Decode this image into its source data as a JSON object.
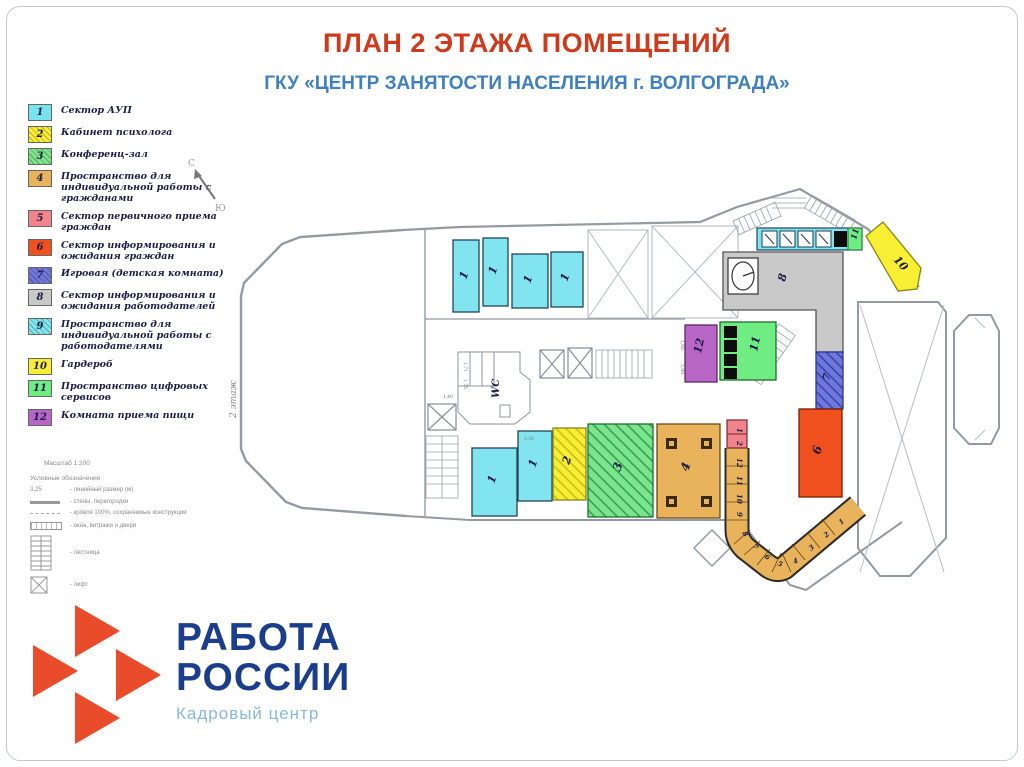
{
  "title": "ПЛАН 2 ЭТАЖА ПОМЕЩЕНИЙ",
  "subtitle": "ГКУ «ЦЕНТР ЗАНЯТОСТИ НАСЕЛЕНИЯ г. ВОЛГОГРАДА»",
  "colors": {
    "title": "#ce3a1c",
    "subtitle": "#4080c0",
    "logo_orange": "#e84c2b",
    "logo_blue": "#1b3e8c",
    "logo_lightblue": "#8ab8dc"
  },
  "legend": {
    "items": [
      {
        "num": "1",
        "color": "#76e3ee",
        "hatch": false,
        "label": "Сектор АУП"
      },
      {
        "num": "2",
        "color": "#f8ef35",
        "hatch": true,
        "label": "Кабинет психолога"
      },
      {
        "num": "3",
        "color": "#7ce58c",
        "hatch": true,
        "label": "Конференц-зал"
      },
      {
        "num": "4",
        "color": "#e9b35c",
        "hatch": false,
        "label": "Пространство для индивидуальной работы с гражданами"
      },
      {
        "num": "5",
        "color": "#f2848c",
        "hatch": false,
        "label": "Сектор первичного приема граждан"
      },
      {
        "num": "6",
        "color": "#f0511f",
        "hatch": false,
        "label": "Сектор информирования и ожидания граждан"
      },
      {
        "num": "7",
        "color": "#7078dc",
        "hatch": true,
        "label": "Игровая (детская комната)"
      },
      {
        "num": "8",
        "color": "#c9c9c9",
        "hatch": false,
        "label": "Сектор информирования и ожидания работодателей"
      },
      {
        "num": "9",
        "color": "#7fe6ef",
        "hatch": true,
        "label": "Пространство для индивидуальной работы с работодателями"
      },
      {
        "num": "10",
        "color": "#f8ef35",
        "hatch": false,
        "label": "Гардероб"
      },
      {
        "num": "11",
        "color": "#6fec82",
        "hatch": false,
        "label": "Пространство цифровых сервисов"
      },
      {
        "num": "12",
        "color": "#b766c5",
        "hatch": false,
        "label": "Комната приема пищи"
      }
    ]
  },
  "symbols_block": {
    "scale": "Масштаб 1:200",
    "title": "Условные обозначения",
    "rows": [
      {
        "sym": "dimension",
        "label": "- линейный размер (м)",
        "prefix": "3,25"
      },
      {
        "sym": "wall",
        "label": "- стены, перегородки"
      },
      {
        "sym": "line",
        "label": "- кровля 100%, сохраняемые конструкции"
      },
      {
        "sym": "window",
        "label": "- окна, витражи и двери"
      },
      {
        "sym": "stairs",
        "label": "- лестница"
      },
      {
        "sym": "lift",
        "label": "- лифт"
      }
    ]
  },
  "plan": {
    "floor_label": "2 этаж",
    "north_n": "С",
    "north_s": "Ю",
    "wc_label": "WC",
    "rooms": {
      "aup": "1",
      "psy": "2",
      "conf": "3",
      "indiv": "4",
      "prim": "5",
      "wait": "6",
      "play": "7",
      "emp": "8",
      "ward": "10",
      "digital": "11",
      "food": "12"
    },
    "counter_cells": [
      "1",
      "2",
      "12",
      "11",
      "10",
      "9",
      "8",
      "7",
      "6",
      "5",
      "4",
      "3",
      "2",
      "1"
    ],
    "dimensions": [
      "1,60",
      "2,80",
      "3,30",
      "1,71",
      "1,75",
      "1,40"
    ]
  },
  "logo": {
    "line1": "РАБОТА",
    "line2": "РОССИИ",
    "subtitle": "Кадровый центр"
  }
}
